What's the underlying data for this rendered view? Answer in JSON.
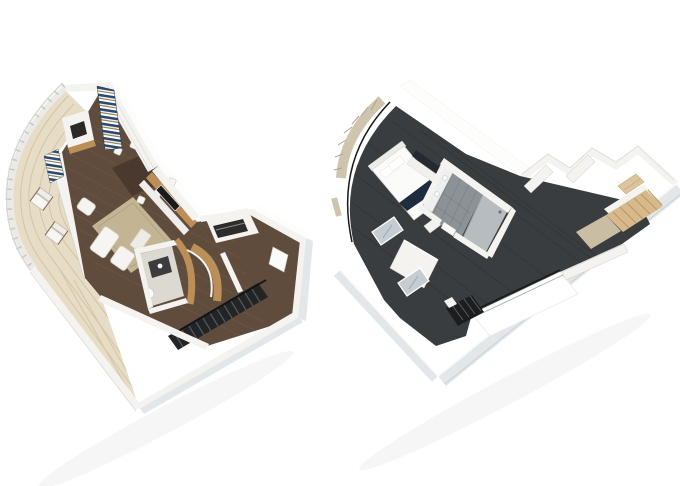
{
  "page": {
    "background": "#ffffff",
    "description": "Two-level loft suite 3D floor plan, isometric cutaway renderings side by side"
  },
  "palette": {
    "bg": "#ffffff",
    "deck": "#e7ddc6",
    "deckLine": "#d2c4a4",
    "woodFloor": "#5f4c3c",
    "woodFloorLine": "#74614f",
    "rug": "#c3b493",
    "rugLine": "#b0a280",
    "oak": "#bd8f58",
    "wallWhite": "#f4f3f0",
    "wallBright": "#fdfdfc",
    "wallEdge": "#cbc9c5",
    "exterior": "#e3e7ea",
    "carpet": "#3a3d3f",
    "carpetLine": "#2d3032",
    "stairDark": "#232426",
    "stairTread": "#56595b",
    "navy": "#1e2c3d",
    "curtainNavy": "#2c4a6e",
    "curtainOlive": "#8c7e52",
    "curtainBeige": "#cfc4ae",
    "curtainBeigeLine": "#b1a48c",
    "mirrorGlass": "#c5ccd2",
    "bathTile": "#8d9296",
    "bathTileLine": "#6f7478",
    "stairWood": "#d7b98c",
    "landing": "#c9bda3"
  },
  "floorplans": [
    {
      "id": "lower-level",
      "position": "left",
      "rooms": [
        "wrap-around balcony",
        "living room",
        "dining area",
        "wet bar",
        "powder room",
        "staircase",
        "entry hall"
      ],
      "furniture": [
        "lounge chair",
        "lounge chair",
        "sofa",
        "armchair",
        "coffee table",
        "area rug",
        "dining table",
        "dining chairs",
        "tv cabinet",
        "striped curtain",
        "bar cabinet",
        "vanity",
        "toilet",
        "curved oak stair wall",
        "dark stair treads",
        "entry door"
      ]
    },
    {
      "id": "upper-level",
      "position": "right",
      "rooms": [
        "master bedroom",
        "master bathroom",
        "shower room",
        "wardrobe area",
        "hallway",
        "upper landing",
        "loft overlook void"
      ],
      "furniture": [
        "bed with navy runner",
        "headboard",
        "pillows",
        "foot bench",
        "tv console",
        "sheer curtains",
        "curved window frame",
        "mirrored wardrobe doors",
        "double-sink vanity",
        "wall mirrors",
        "glass balustrade",
        "stairs down",
        "wood stairs up",
        "closet shelf"
      ]
    }
  ]
}
